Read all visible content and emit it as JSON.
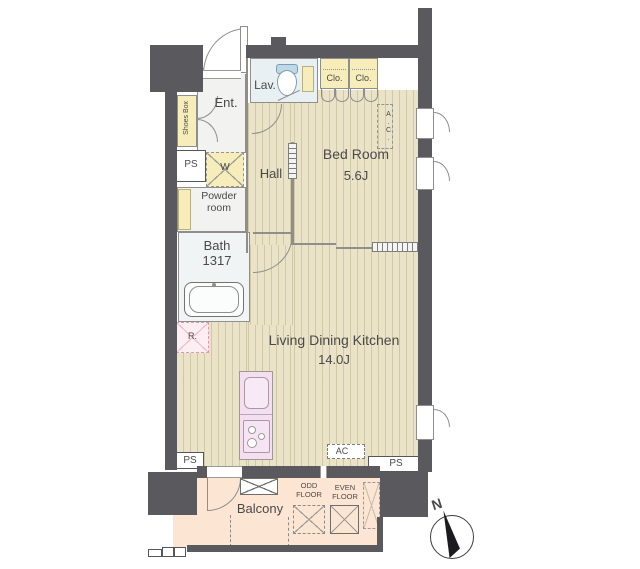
{
  "labels": {
    "ent": "Ent.",
    "shoes_box": "Shoes Box",
    "lav": "Lav.",
    "clo_left": "Clo.",
    "clo_right": "Clo.",
    "ps_top": "PS",
    "washer": "W",
    "powder_room": "Powder room",
    "bath": "Bath",
    "bath_size": "1317",
    "hall": "Hall",
    "bedroom": "Bed Room",
    "bedroom_size": "5.6J",
    "bedroom_ac": "A.C.",
    "fridge": "R.",
    "ldk": "Living Dining Kitchen",
    "ldk_size": "14.0J",
    "living_ac": "AC",
    "ps_bottom_left": "PS",
    "ps_bottom_right": "PS",
    "balcony": "Balcony",
    "odd_floor": "ODD FLOOR",
    "even_floor": "EVEN FLOOR",
    "compass_north": "N"
  },
  "colors": {
    "wall": "#5a5a5e",
    "wood_floor": "#eae3c7",
    "balcony": "#fce5d3",
    "fixture_yellow": "#f6edbb",
    "kitchen_pink": "#f4def0",
    "fridge_pink": "#fdeef3",
    "lav_blue": "#e9f0f3",
    "white_room": "#f2f2f0",
    "text": "#4a4a4b"
  }
}
